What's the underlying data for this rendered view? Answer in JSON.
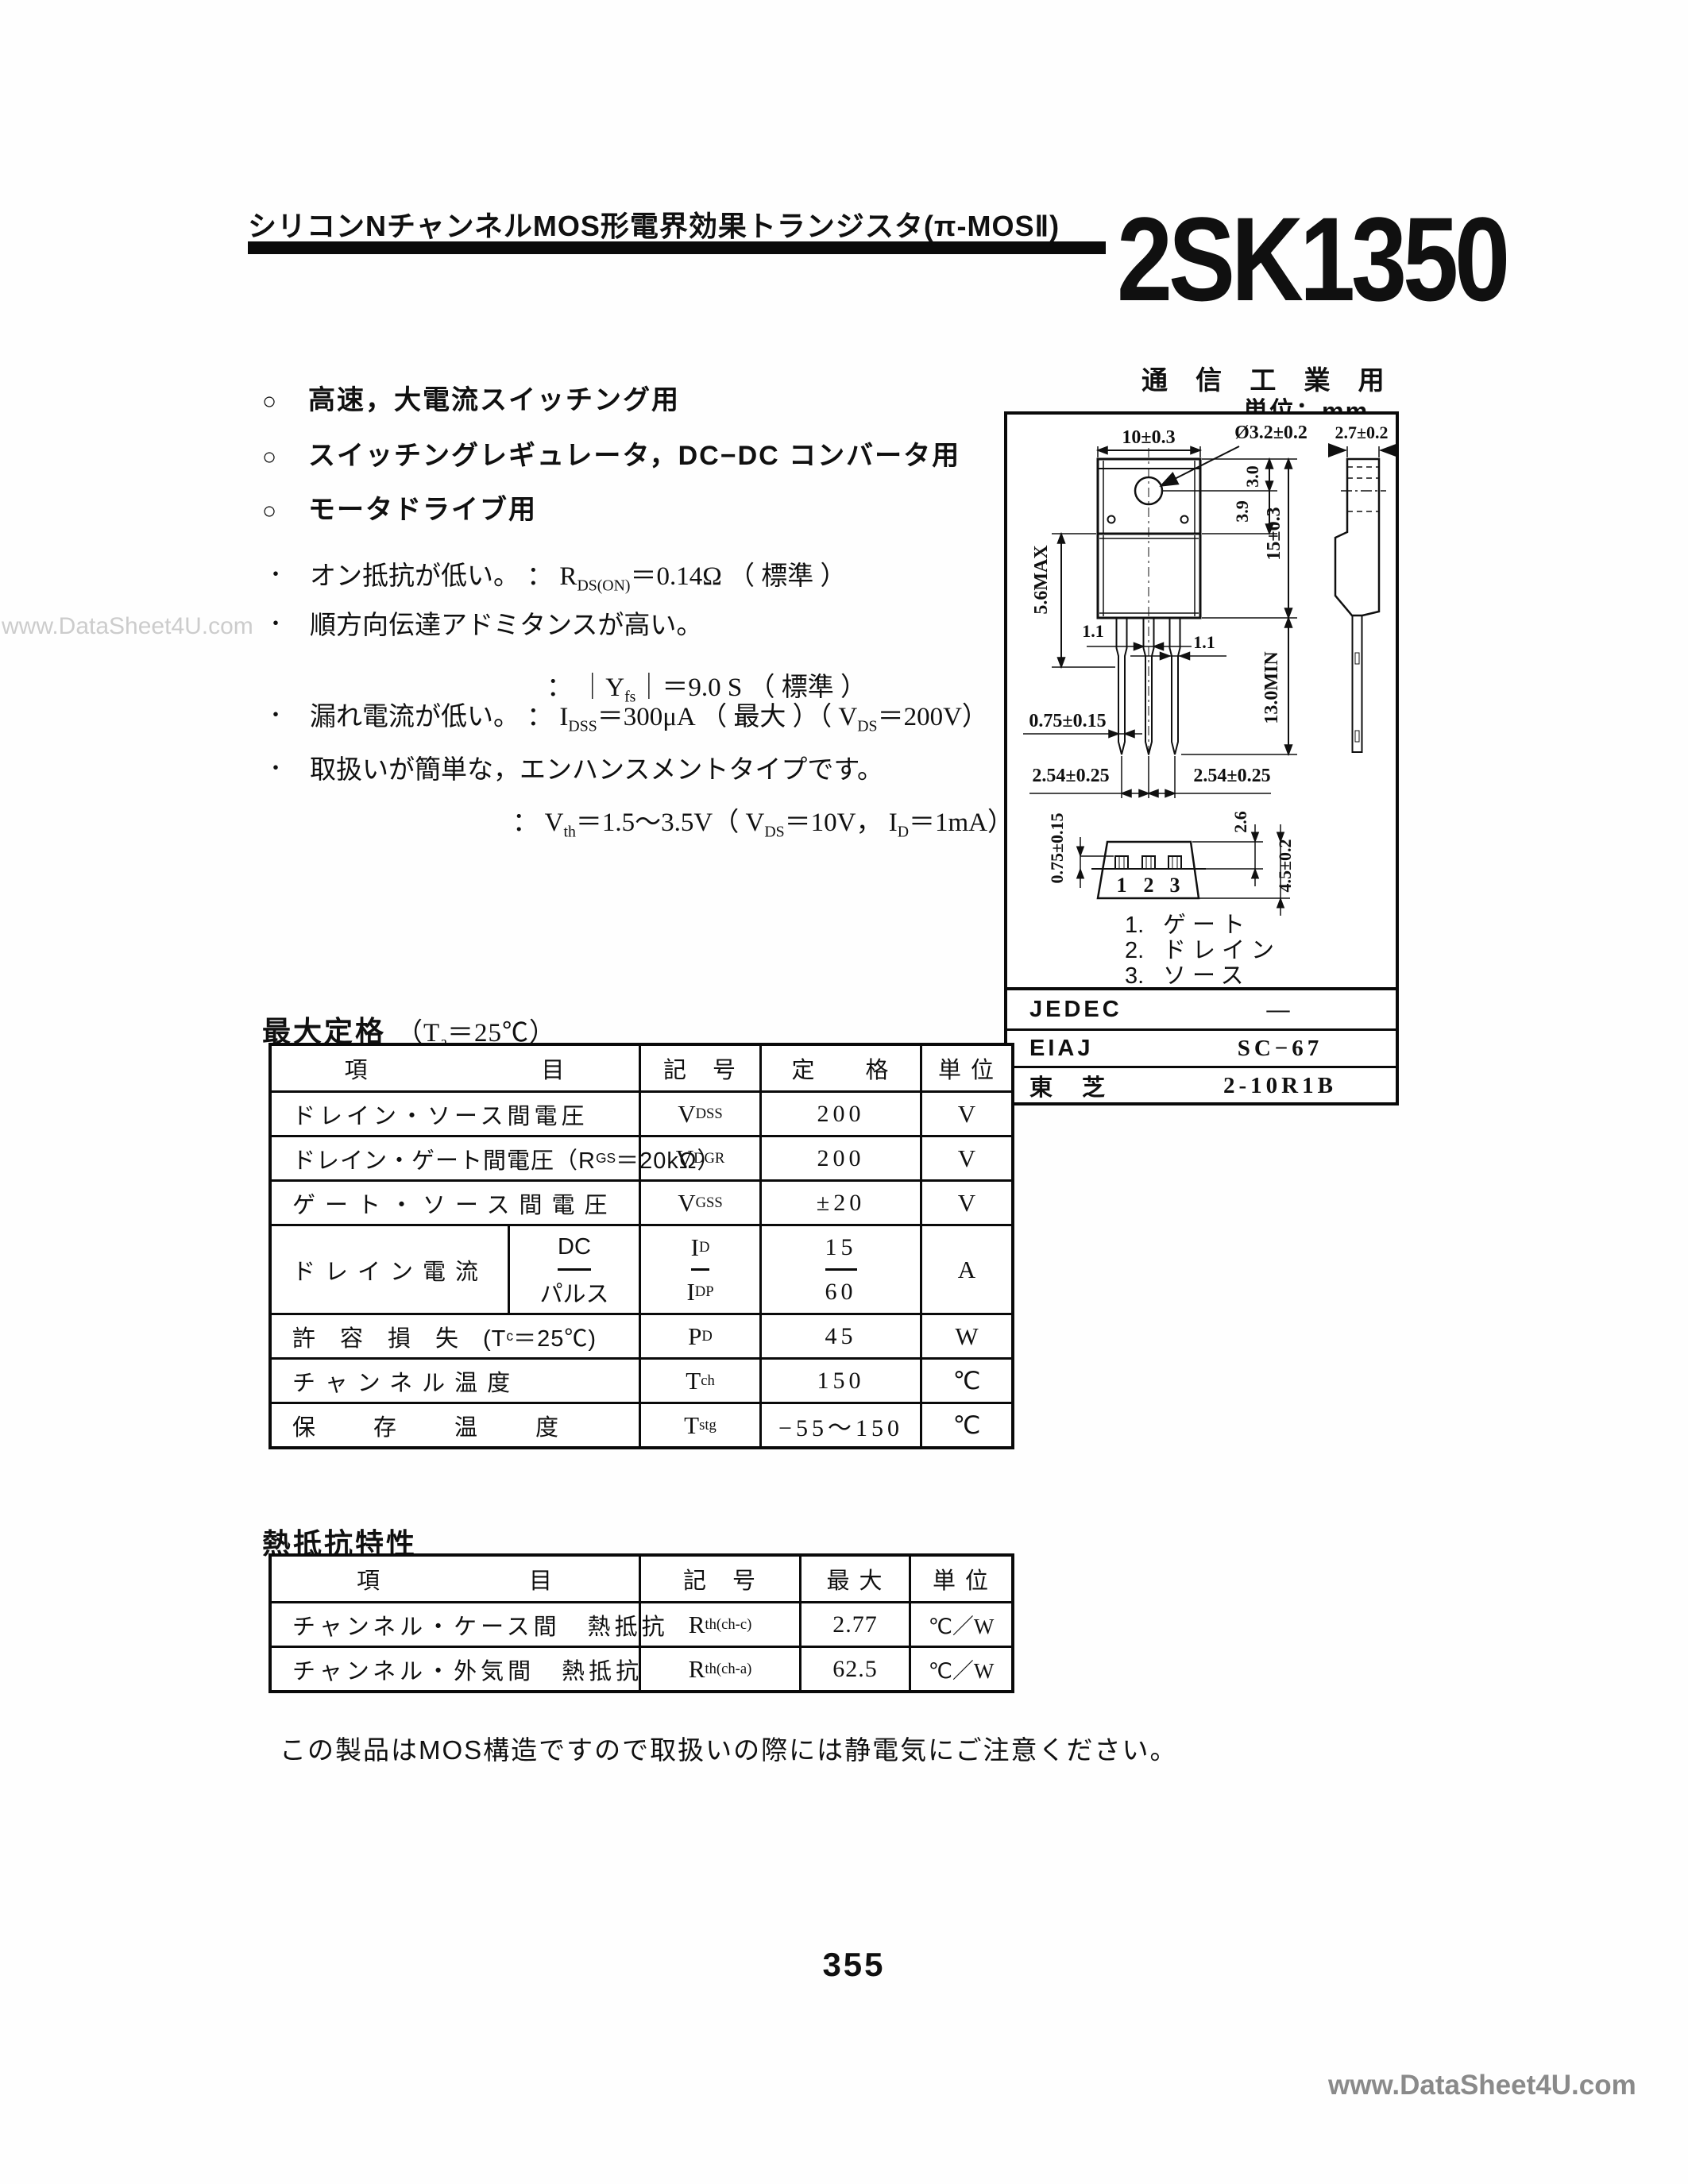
{
  "header": {
    "title": "シリコンNチャンネルMOS形電界効果トランジスタ(π-MOSⅡ)",
    "part_number": "2SK1350"
  },
  "misc": {
    "usage": "通 信 工 業 用",
    "unit_label": "単位：mm",
    "note": "この製品はMOS構造ですので取扱いの際には静電気にご注意ください。",
    "page_number": "355",
    "watermark_left": "www.DataSheet4U.com",
    "watermark_bottom": "www.DataSheet4U.com"
  },
  "colors": {
    "ink": "#101010",
    "paper": "#fefefe",
    "watermark_light": "#cccccc",
    "watermark_dark": "#8a8a8a"
  },
  "applications": [
    {
      "bullet": "○",
      "text": "高速，大電流スイッチング用"
    },
    {
      "bullet": "○",
      "text": "スイッチングレギュレータ，DC−DC コンバータ用"
    },
    {
      "bullet": "○",
      "text": "モータドライブ用"
    }
  ],
  "features": {
    "f1": {
      "bullet": "・",
      "jp": "オン抵抗が低い。 ：",
      "t1": " R",
      "s1": "DS(ON)",
      "t2": "＝0.14Ω （ 標準 ）"
    },
    "f2": {
      "bullet": "・",
      "jp": "順方向伝達アドミタンスが高い。"
    },
    "f2c": {
      "t1": "： ｜Y",
      "s1": "fs",
      "t2": "｜＝9.0 S （ 標準 ）"
    },
    "f3": {
      "bullet": "・",
      "jp": "漏れ電流が低い。 ：",
      "t1": " I",
      "s1": "DSS",
      "t2": "＝300μA （ 最大 ）（ V",
      "s2": "DS",
      "t3": "＝200V）"
    },
    "f4": {
      "bullet": "・",
      "jp": "取扱いが簡単な，エンハンスメントタイプです。"
    },
    "f4c": {
      "t1": "： V",
      "s1": "th",
      "t2": "＝1.5〜3.5V（ V",
      "s2": "DS",
      "t3": "＝10V， I",
      "s3": "D",
      "t4": "＝1mA）"
    }
  },
  "drawing": {
    "dims": {
      "top_width": "10±0.3",
      "hole_dia": "Ø3.2±0.2",
      "side_width": "2.7±0.2",
      "d30": "3.0",
      "d39": "3.9",
      "height": "15±0.3",
      "body_max": "5.6MAX",
      "lead_w1": "1.1",
      "lead_w2": "1.1",
      "lead_thk": "0.75±0.15",
      "lead_len": "13.0MIN",
      "pitch_l": "2.54±0.25",
      "pitch_r": "2.54±0.25",
      "bv_thk": "0.75±0.15",
      "bv_d26": "2.6",
      "bv_h": "4.5±0.2",
      "pin1": "1",
      "pin2": "2",
      "pin3": "3"
    },
    "legend": [
      {
        "n": "1.",
        "label": "ゲート"
      },
      {
        "n": "2.",
        "label": "ドレイン"
      },
      {
        "n": "3.",
        "label": "ソース"
      }
    ]
  },
  "pkg_table": {
    "r1": {
      "label": "JEDEC",
      "value": "―"
    },
    "r2": {
      "label": "EIAJ",
      "value": "SC−67"
    },
    "r3": {
      "label": "東　芝",
      "value": "2-10R1B"
    }
  },
  "max_table": {
    "title": "最大定格",
    "cond_pre": "（T",
    "cond_sub": "a",
    "cond_post": "＝25℃）",
    "header": {
      "item": "項　　　　　　　目",
      "symbol": "記　号",
      "rating": "定　　格",
      "unit": "単 位"
    },
    "r1": {
      "item": "ドレイン・ソース間電圧",
      "sym": "V",
      "sub": "DSS",
      "rating": "200",
      "unit": "V"
    },
    "r2": {
      "item_pre": "ドレイン・ゲート間電圧（R",
      "item_sub": "GS",
      "item_post": "＝20kΩ）",
      "sym": "V",
      "sub": "DGR",
      "rating": "200",
      "unit": "V"
    },
    "r3": {
      "item": "ゲート・ソース間電圧",
      "sym": "V",
      "sub": "GSS",
      "rating": "±20",
      "unit": "V"
    },
    "drain": {
      "label": "ドレイン電流",
      "dc": "DC",
      "pulse": "パルス",
      "sym1": "I",
      "sub1": "D",
      "rating1": "15",
      "sym2": "I",
      "sub2": "DP",
      "rating2": "60",
      "unit": "A"
    },
    "r5": {
      "item_pre": "許　容　損　失　(T",
      "item_sub": "c",
      "item_post": "＝25℃)",
      "sym": "P",
      "sub": "D",
      "rating": "45",
      "unit": "W"
    },
    "r6": {
      "item": "チャンネル温度",
      "sym": "T",
      "sub": "ch",
      "rating": "150",
      "unit": "℃"
    },
    "r7": {
      "item": "保　　存　　温　　度",
      "sym": "T",
      "sub": "stg",
      "rating": "−55〜150",
      "unit": "℃"
    }
  },
  "thermal_table": {
    "title": "熱抵抗特性",
    "header": {
      "item": "項　　　　　　目",
      "symbol": "記　号",
      "max": "最 大",
      "unit": "単 位"
    },
    "r1": {
      "item": "チャンネル・ケース間　熱抵抗",
      "sym": "R",
      "sub": "th(ch-c)",
      "max": "2.77",
      "unit": "℃／W"
    },
    "r2": {
      "item": "チャンネル・外気間　熱抵抗",
      "sym": "R",
      "sub": "th(ch-a)",
      "max": "62.5",
      "unit": "℃／W"
    }
  }
}
